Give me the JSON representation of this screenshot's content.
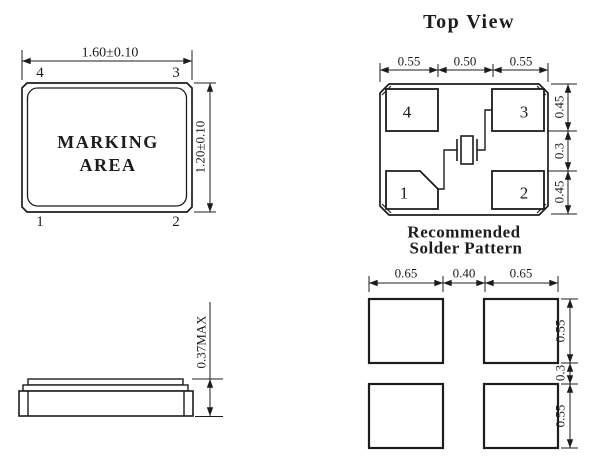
{
  "colors": {
    "line": "#1c1c1c",
    "background": "#ffffff"
  },
  "front_view": {
    "marking_line1": "MARKING",
    "marking_line2": "AREA",
    "width_dim": "1.60±0.10",
    "height_dim": "1.20±0.10",
    "pin_top_left": "4",
    "pin_top_right": "3",
    "pin_bottom_left": "1",
    "pin_bottom_right": "2"
  },
  "top_view": {
    "title": "Top View",
    "pad_top_left": "4",
    "pad_top_right": "3",
    "pad_bottom_left": "1",
    "pad_bottom_right": "2",
    "dim_top_left": "0.55",
    "dim_top_mid": "0.50",
    "dim_top_right": "0.55",
    "dim_right_top": "0.45",
    "dim_right_mid": "0.3",
    "dim_right_bottom": "0.45"
  },
  "side_view": {
    "height_dim": "0.37MAX"
  },
  "solder_pattern": {
    "title_line1": "Recommended",
    "title_line2": "Solder Pattern",
    "dim_top_left": "0.65",
    "dim_top_mid": "0.40",
    "dim_top_right": "0.65",
    "dim_right_top": "0.55",
    "dim_right_mid": "0.3",
    "dim_right_bottom": "0.55"
  }
}
